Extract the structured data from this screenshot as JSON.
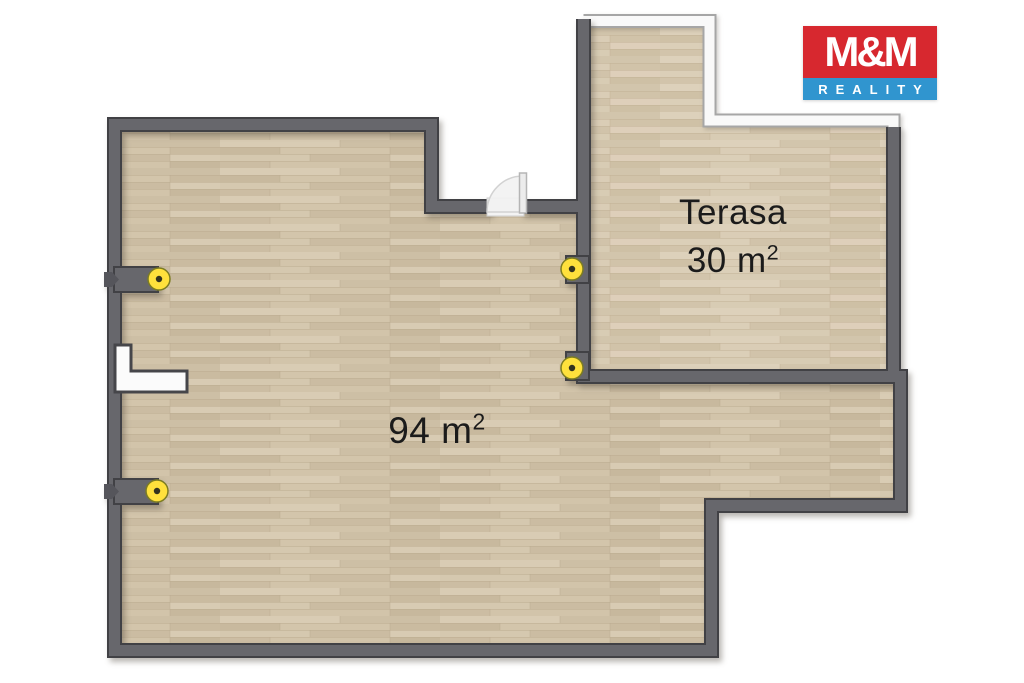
{
  "page": {
    "background": "#ffffff"
  },
  "plan": {
    "rooms": [
      {
        "id": "main-room",
        "area": "94 m",
        "area_sup": "2"
      },
      {
        "id": "terrace",
        "name": "Terasa",
        "area": "30 m",
        "area_sup": "2"
      }
    ],
    "colors": {
      "wall": "#67676c",
      "wall_outline": "#414145",
      "floor": "#cfc1a8",
      "terrace_floor": "#d6c9b1",
      "railing": "#f9f9f9",
      "railing_outline": "#a6a6a6",
      "door": "#f2f2f2",
      "marker_yellow": "#ffe13c",
      "marker_center": "#33331f",
      "label_text": "#1b1b1b"
    },
    "markers": {
      "count": 4,
      "type": "yellow-point"
    }
  },
  "logo": {
    "name": "M&M",
    "tagline": "REALITY",
    "red": "#d7282f",
    "blue": "#3095cf"
  }
}
